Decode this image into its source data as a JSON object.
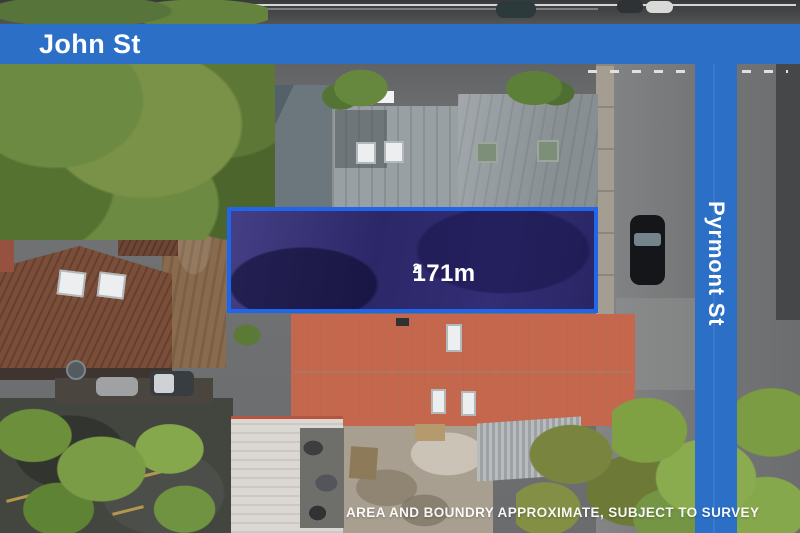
{
  "overlay": {
    "street_banner_top": {
      "label": "John St"
    },
    "street_banner_right": {
      "label": "Pyrmont St"
    },
    "lot": {
      "area_value": "171m",
      "area_sup": "2",
      "area_full": "171m²"
    },
    "disclaimer": "AREA AND BOUNDRY APPROXIMATE, SUBJECT TO SURVEY"
  },
  "colors": {
    "banner_blue": "#2b6fc7",
    "lot_border_blue": "#2066e8",
    "lot_fill_indigo": "#332e75",
    "overlay_text_white": "#ffffff"
  }
}
